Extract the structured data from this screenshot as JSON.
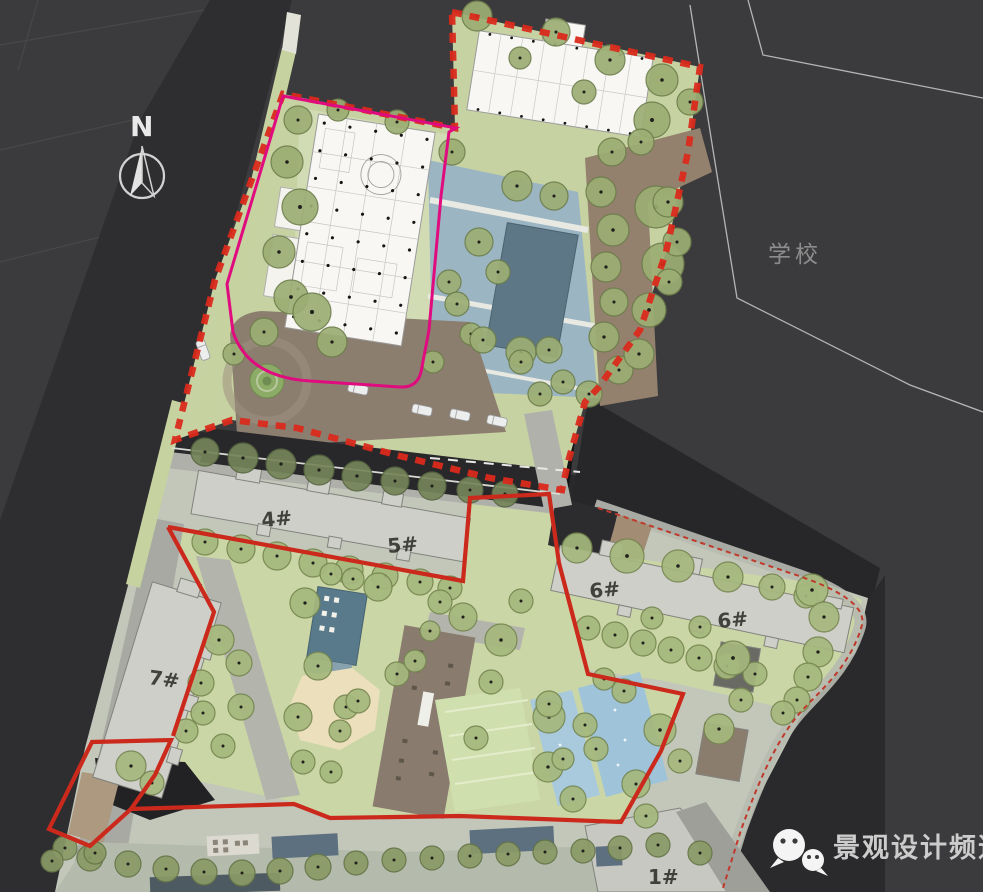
{
  "title": "residential-landscape-master-plan",
  "compass": {
    "label": "N"
  },
  "labels": {
    "school": "学校",
    "buildings": [
      {
        "text": "4#"
      },
      {
        "text": "5#"
      },
      {
        "text": "6#"
      },
      {
        "text": "6#"
      },
      {
        "text": "7#"
      },
      {
        "text": "1#"
      }
    ]
  },
  "watermark": {
    "icon": "wechat-icon",
    "text": "景观设计频道"
  },
  "colors": {
    "background": "#3b3b3d",
    "road_dark": "#29292c",
    "road_black": "#141416",
    "boundary_red": "#da2a1c",
    "boundary_red_solid": "#cc291d",
    "boundary_magenta": "#e00b7e",
    "lawn_green": "#c7d2a2",
    "tree_olive": "#9cae74",
    "water_blue": "#9cb5c2",
    "pool_blue": "#a9cadd",
    "path_brown": "#93816e",
    "building_gray": "#cfcfca",
    "plan_white": "#f8f7f3",
    "school_line": "#b5b5b5",
    "watermark_gray": "#cccccc"
  },
  "trees_groups": [
    {
      "id": "upper",
      "fill": "#9cae74",
      "stroke": "#6d7e4b",
      "pts": [
        [
          477,
          16,
          15
        ],
        [
          556,
          32,
          14
        ],
        [
          610,
          60,
          15
        ],
        [
          662,
          80,
          16
        ],
        [
          690,
          102,
          13
        ],
        [
          652,
          120,
          18
        ],
        [
          520,
          58,
          11
        ],
        [
          584,
          92,
          12
        ],
        [
          298,
          120,
          14
        ],
        [
          287,
          162,
          16
        ],
        [
          300,
          207,
          18
        ],
        [
          279,
          252,
          16
        ],
        [
          291,
          297,
          17
        ],
        [
          264,
          332,
          14
        ],
        [
          312,
          312,
          19
        ],
        [
          332,
          342,
          15
        ],
        [
          234,
          354,
          11
        ],
        [
          612,
          152,
          14
        ],
        [
          601,
          192,
          15
        ],
        [
          613,
          230,
          16
        ],
        [
          606,
          267,
          15
        ],
        [
          614,
          302,
          14
        ],
        [
          604,
          337,
          15
        ],
        [
          619,
          370,
          14
        ],
        [
          589,
          394,
          13
        ],
        [
          641,
          142,
          13
        ],
        [
          656,
          207,
          21
        ],
        [
          663,
          264,
          21
        ],
        [
          649,
          310,
          17
        ],
        [
          639,
          354,
          15
        ],
        [
          668,
          202,
          15
        ],
        [
          677,
          242,
          14
        ],
        [
          669,
          282,
          13
        ],
        [
          452,
          152,
          13
        ],
        [
          517,
          186,
          15
        ],
        [
          554,
          196,
          14
        ],
        [
          479,
          242,
          14
        ],
        [
          449,
          282,
          12
        ],
        [
          498,
          272,
          12
        ],
        [
          457,
          304,
          12
        ],
        [
          471,
          334,
          11
        ],
        [
          521,
          352,
          15
        ],
        [
          433,
          362,
          11
        ],
        [
          338,
          110,
          11
        ],
        [
          397,
          122,
          12
        ],
        [
          483,
          340,
          13
        ],
        [
          521,
          362,
          12
        ],
        [
          549,
          350,
          13
        ],
        [
          563,
          382,
          12
        ],
        [
          540,
          394,
          12
        ]
      ]
    },
    {
      "id": "roadrow",
      "fill": "#76855a",
      "stroke": "#566540",
      "pts": [
        [
          205,
          452,
          14
        ],
        [
          243,
          458,
          15
        ],
        [
          281,
          464,
          15
        ],
        [
          319,
          470,
          15
        ],
        [
          357,
          476,
          15
        ],
        [
          395,
          481,
          14
        ],
        [
          432,
          486,
          14
        ],
        [
          470,
          490,
          13
        ],
        [
          505,
          494,
          13
        ]
      ]
    },
    {
      "id": "lower",
      "fill": "#a5b87d",
      "stroke": "#75864f",
      "pts": [
        [
          205,
          542,
          13
        ],
        [
          241,
          549,
          14
        ],
        [
          277,
          556,
          14
        ],
        [
          313,
          563,
          14
        ],
        [
          349,
          570,
          14
        ],
        [
          385,
          576,
          13
        ],
        [
          420,
          582,
          13
        ],
        [
          450,
          588,
          12
        ],
        [
          577,
          548,
          15
        ],
        [
          627,
          556,
          17
        ],
        [
          678,
          566,
          16
        ],
        [
          728,
          577,
          15
        ],
        [
          772,
          587,
          13
        ],
        [
          806,
          596,
          12
        ],
        [
          588,
          628,
          12
        ],
        [
          615,
          635,
          13
        ],
        [
          643,
          643,
          13
        ],
        [
          671,
          650,
          13
        ],
        [
          699,
          658,
          13
        ],
        [
          727,
          666,
          13
        ],
        [
          755,
          674,
          12
        ],
        [
          700,
          627,
          11
        ],
        [
          652,
          618,
          11
        ],
        [
          812,
          590,
          16
        ],
        [
          824,
          617,
          15
        ],
        [
          818,
          652,
          15
        ],
        [
          808,
          677,
          14
        ],
        [
          797,
          700,
          13
        ],
        [
          783,
          713,
          12
        ],
        [
          733,
          658,
          17
        ],
        [
          719,
          729,
          15
        ],
        [
          741,
          700,
          12
        ],
        [
          219,
          640,
          15
        ],
        [
          239,
          663,
          13
        ],
        [
          201,
          683,
          13
        ],
        [
          241,
          707,
          13
        ],
        [
          203,
          713,
          12
        ],
        [
          186,
          731,
          12
        ],
        [
          223,
          746,
          12
        ],
        [
          131,
          766,
          15
        ],
        [
          152,
          783,
          12
        ],
        [
          305,
          603,
          15
        ],
        [
          331,
          574,
          11
        ],
        [
          353,
          579,
          11
        ],
        [
          378,
          587,
          14
        ],
        [
          440,
          602,
          12
        ],
        [
          463,
          617,
          14
        ],
        [
          501,
          640,
          16
        ],
        [
          318,
          666,
          14
        ],
        [
          397,
          674,
          12
        ],
        [
          491,
          682,
          12
        ],
        [
          298,
          717,
          14
        ],
        [
          346,
          707,
          12
        ],
        [
          549,
          717,
          16
        ],
        [
          476,
          738,
          12
        ],
        [
          303,
          762,
          12
        ],
        [
          331,
          772,
          11
        ],
        [
          548,
          767,
          15
        ],
        [
          415,
          661,
          11
        ],
        [
          430,
          631,
          10
        ],
        [
          521,
          601,
          12
        ],
        [
          358,
          701,
          12
        ],
        [
          340,
          731,
          11
        ],
        [
          549,
          704,
          13
        ],
        [
          585,
          725,
          12
        ],
        [
          596,
          749,
          12
        ],
        [
          563,
          759,
          11
        ],
        [
          573,
          799,
          13
        ],
        [
          636,
          784,
          14
        ],
        [
          660,
          730,
          16
        ],
        [
          624,
          691,
          12
        ],
        [
          604,
          679,
          11
        ],
        [
          680,
          761,
          12
        ],
        [
          646,
          816,
          12
        ]
      ]
    },
    {
      "id": "bottomrow",
      "fill": "#8a9a66",
      "stroke": "#647446",
      "pts": [
        [
          90,
          858,
          13
        ],
        [
          128,
          864,
          13
        ],
        [
          166,
          869,
          13
        ],
        [
          204,
          872,
          13
        ],
        [
          242,
          873,
          13
        ],
        [
          280,
          871,
          13
        ],
        [
          318,
          867,
          13
        ],
        [
          356,
          863,
          12
        ],
        [
          394,
          860,
          12
        ],
        [
          432,
          858,
          12
        ],
        [
          470,
          856,
          12
        ],
        [
          508,
          854,
          12
        ],
        [
          545,
          852,
          12
        ],
        [
          583,
          851,
          12
        ],
        [
          620,
          848,
          12
        ],
        [
          658,
          845,
          12
        ],
        [
          65,
          848,
          12
        ],
        [
          52,
          861,
          11
        ],
        [
          95,
          853,
          11
        ],
        [
          700,
          853,
          12
        ]
      ]
    }
  ],
  "cars": [
    [
      422,
      410,
      12
    ],
    [
      460,
      415,
      12
    ],
    [
      497,
      421,
      12
    ],
    [
      358,
      389,
      12
    ],
    [
      203,
      350,
      70
    ]
  ]
}
